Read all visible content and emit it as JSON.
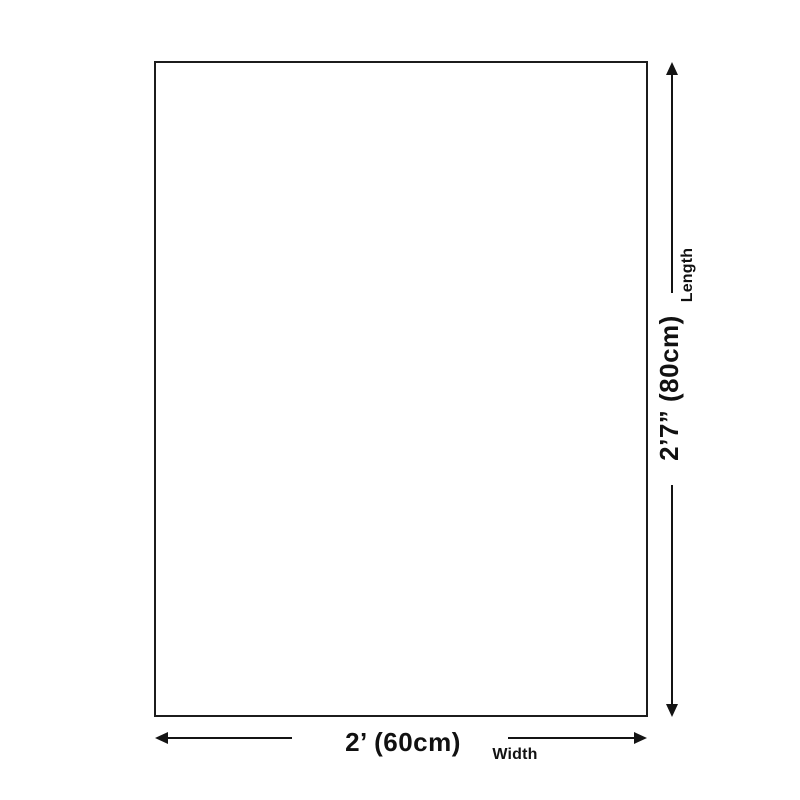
{
  "diagram": {
    "type": "product-dimension-diagram",
    "length": {
      "value": "2’7” (80cm)",
      "label": "Length"
    },
    "width": {
      "value": "2’ (60cm)",
      "label": "Width"
    }
  },
  "colors": {
    "background": "#ffffff",
    "outline": "#1c1c1c",
    "dimension_line": "#141414",
    "text": "#111111"
  }
}
